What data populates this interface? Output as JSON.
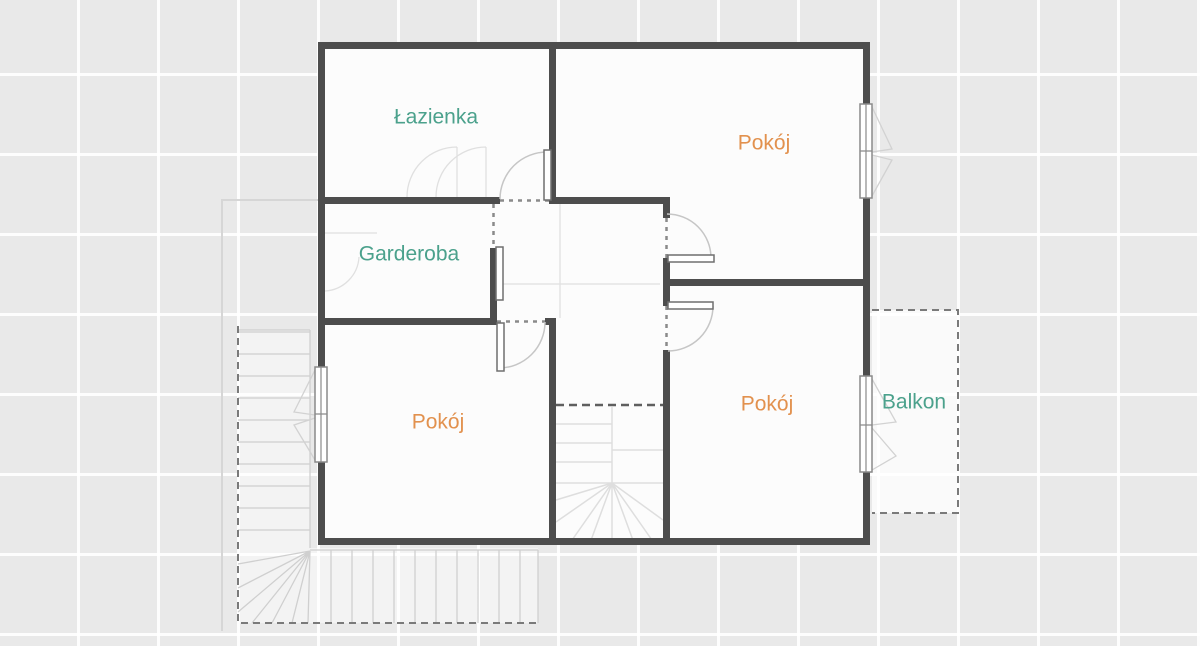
{
  "plan": {
    "rooms": [
      {
        "id": "lazienka",
        "label": "Łazienka",
        "color": "#4ba18c"
      },
      {
        "id": "pokoj-top-right",
        "label": "Pokój",
        "color": "#e2914e"
      },
      {
        "id": "garderoba",
        "label": "Garderoba",
        "color": "#4ba18c"
      },
      {
        "id": "pokoj-bottom-left",
        "label": "Pokój",
        "color": "#e2914e"
      },
      {
        "id": "pokoj-bottom-right",
        "label": "Pokój",
        "color": "#e2914e"
      },
      {
        "id": "balkon",
        "label": "Balkon",
        "color": "#4ba18c"
      }
    ],
    "colors": {
      "wall": "#4d4d4d",
      "floor": "#fcfcfc",
      "background": "#e9e9e9",
      "grid_line": "#ffffff",
      "accent_teal": "#4ba18c",
      "accent_orange": "#e2914e"
    }
  }
}
